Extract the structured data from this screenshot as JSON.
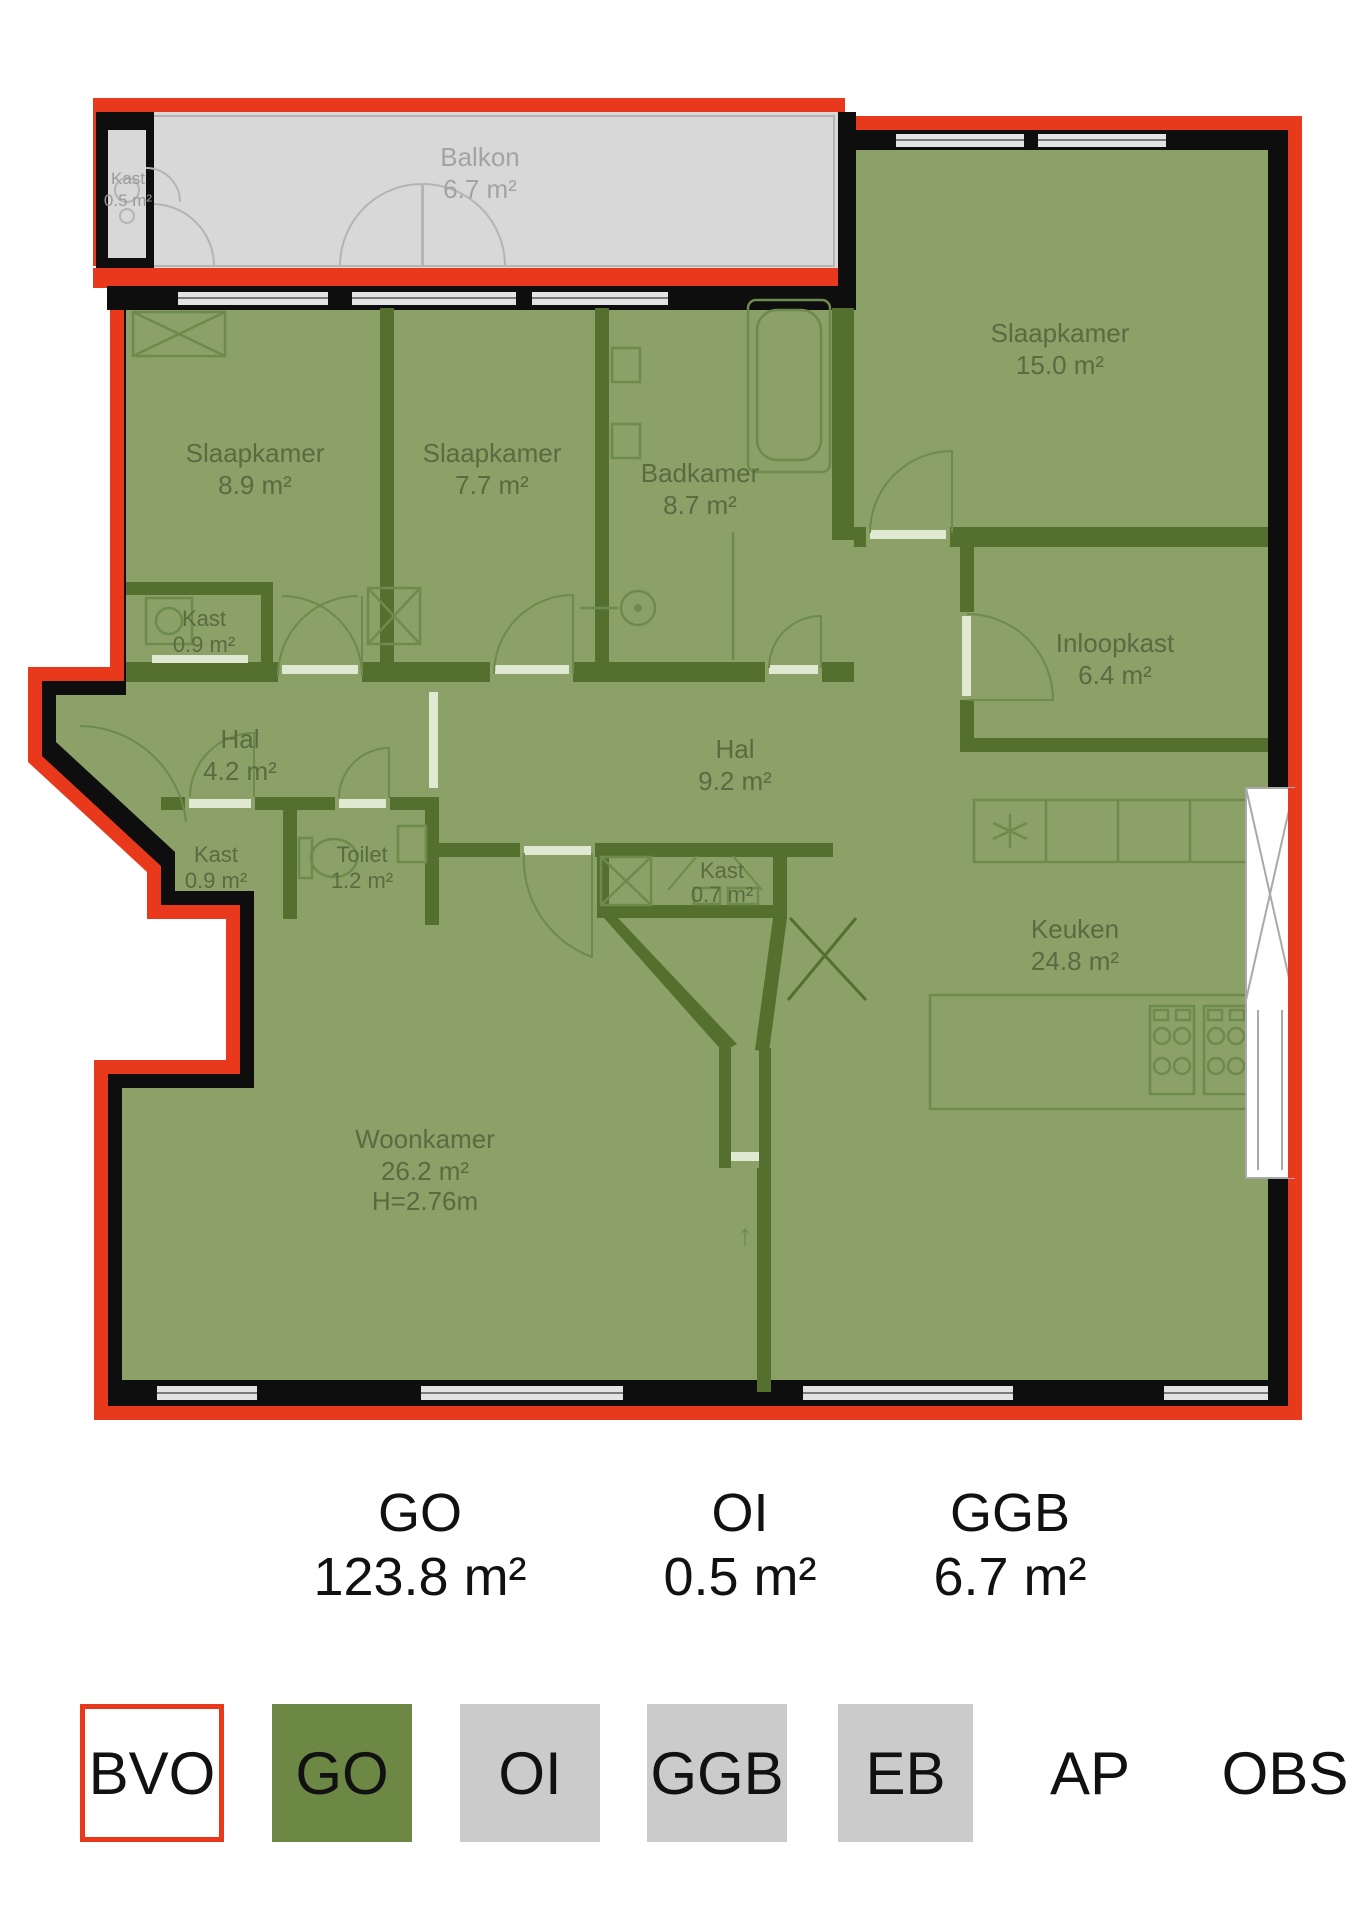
{
  "plan": {
    "rooms": [
      {
        "name": "Kast",
        "area": "0.5 m²"
      },
      {
        "name": "Balkon",
        "area": "6.7 m²"
      },
      {
        "name": "Slaapkamer",
        "area": "8.9 m²"
      },
      {
        "name": "Slaapkamer",
        "area": "7.7 m²"
      },
      {
        "name": "Badkamer",
        "area": "8.7 m²"
      },
      {
        "name": "Slaapkamer",
        "area": "15.0 m²"
      },
      {
        "name": "Kast",
        "area": "0.9 m²"
      },
      {
        "name": "Hal",
        "area": "4.2 m²"
      },
      {
        "name": "Hal",
        "area": "9.2 m²"
      },
      {
        "name": "Inloopkast",
        "area": "6.4 m²"
      },
      {
        "name": "Kast",
        "area": "0.9 m²"
      },
      {
        "name": "Toilet",
        "area": "1.2 m²"
      },
      {
        "name": "Kast",
        "area": "0.7 m²"
      },
      {
        "name": "Keuken",
        "area": "24.8 m²"
      },
      {
        "name": "Woonkamer",
        "area": "26.2 m²",
        "ceiling_height": "H=2.76m"
      }
    ]
  },
  "stats": [
    {
      "label": "GO",
      "value": "123.8 m²"
    },
    {
      "label": "OI",
      "value": "0.5 m²"
    },
    {
      "label": "GGB",
      "value": "6.7 m²"
    }
  ],
  "legend": [
    {
      "label": "BVO"
    },
    {
      "label": "GO"
    },
    {
      "label": "OI"
    },
    {
      "label": "GGB"
    },
    {
      "label": "EB"
    },
    {
      "label": "AP"
    },
    {
      "label": "OBS"
    }
  ],
  "colors": {
    "bvo_red": "#e8391c",
    "go_green": "#6d8745",
    "plan_green": "#8ba167",
    "inner_wall_green": "#55702e",
    "area_gray": "#cbcbcb",
    "balcony_gray": "#d8d8d8",
    "wall_black": "#0e0e0e"
  }
}
